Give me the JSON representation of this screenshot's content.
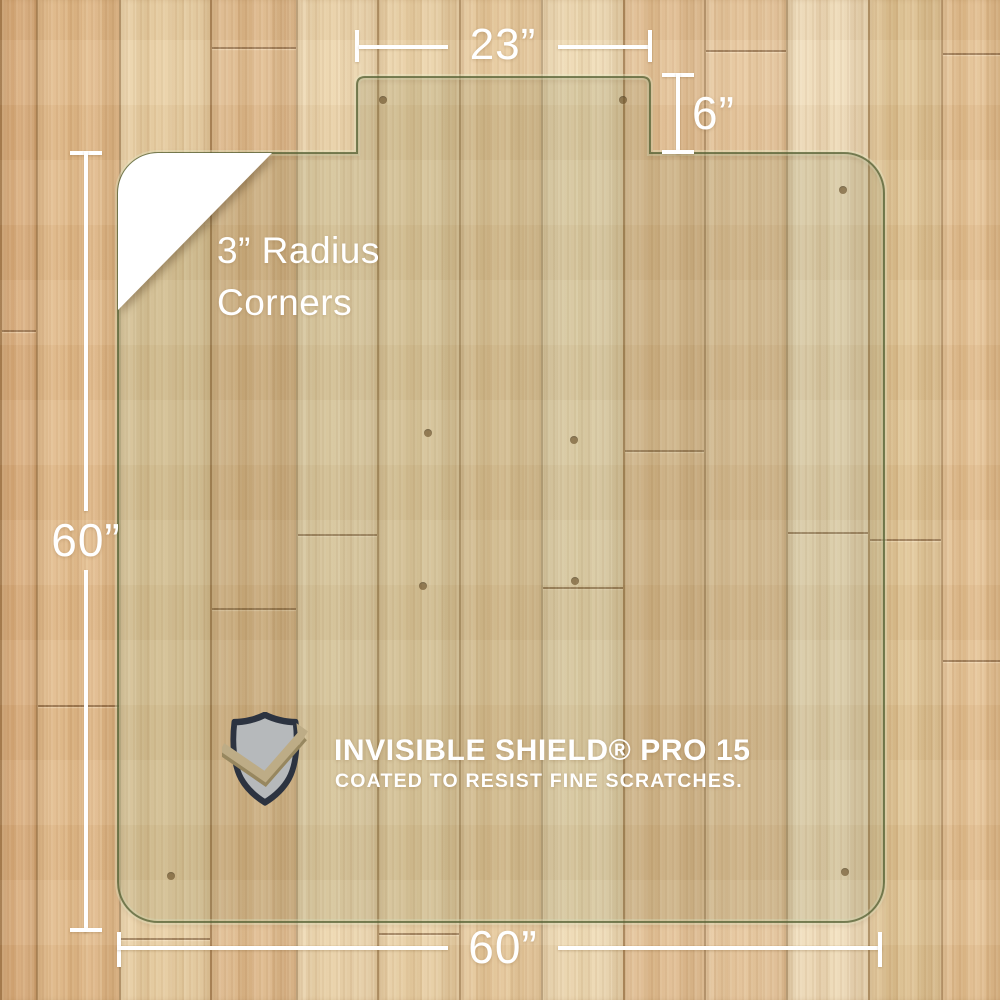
{
  "dimensions": {
    "top_width_label": "23”",
    "notch_depth_label": "6”",
    "side_height_label": "60”",
    "bottom_width_label": "60”"
  },
  "corner_note": {
    "line1": "3” Radius",
    "line2": "Corners"
  },
  "badge": {
    "title": "INVISIBLE SHIELD® PRO 15",
    "subtitle": "COATED TO RESIST FINE SCRATCHES."
  },
  "colors": {
    "dimension_lines": "#ffffff",
    "mat_tint": "rgba(106,112,62,0.16)",
    "mat_edge": "rgba(78,90,45,0.72)",
    "mat_edge_halo": "rgba(235,240,205,0.38)",
    "floor_base": "#e7c99c",
    "plank_seam": "rgba(122,86,44,0.45)",
    "wood_joint": "rgba(108,74,40,0.6)",
    "knot_dot": "#6f4f2a",
    "shield_fill": "#b6b9bb",
    "shield_outline": "#2c3340",
    "check_color": "#bdac86",
    "check_shadow": "#97875f"
  },
  "floor": {
    "planks": [
      {
        "x": 0,
        "w": 36,
        "color": "#d8aa78"
      },
      {
        "x": 36,
        "w": 83,
        "color": "#e2b987"
      },
      {
        "x": 119,
        "w": 91,
        "color": "#ead0a3"
      },
      {
        "x": 210,
        "w": 86,
        "color": "#dfb98a"
      },
      {
        "x": 296,
        "w": 81,
        "color": "#eed7ae"
      },
      {
        "x": 377,
        "w": 82,
        "color": "#ebd2a6"
      },
      {
        "x": 459,
        "w": 82,
        "color": "#e8ca9c"
      },
      {
        "x": 541,
        "w": 82,
        "color": "#f0dcb5"
      },
      {
        "x": 623,
        "w": 81,
        "color": "#e3bf92"
      },
      {
        "x": 704,
        "w": 82,
        "color": "#e8c79c"
      },
      {
        "x": 786,
        "w": 82,
        "color": "#f1debb"
      },
      {
        "x": 868,
        "w": 73,
        "color": "#dfc392"
      },
      {
        "x": 941,
        "w": 59,
        "color": "#e4bf8f"
      }
    ],
    "joints": [
      {
        "x": 210,
        "w": 86,
        "y": 47
      },
      {
        "x": 704,
        "w": 82,
        "y": 50
      },
      {
        "x": 941,
        "w": 59,
        "y": 53
      },
      {
        "x": 0,
        "w": 36,
        "y": 330
      },
      {
        "x": 36,
        "w": 83,
        "y": 705
      },
      {
        "x": 296,
        "w": 81,
        "y": 534
      },
      {
        "x": 623,
        "w": 81,
        "y": 450
      },
      {
        "x": 541,
        "w": 82,
        "y": 587
      },
      {
        "x": 786,
        "w": 82,
        "y": 532
      },
      {
        "x": 868,
        "w": 73,
        "y": 539
      },
      {
        "x": 210,
        "w": 86,
        "y": 608
      },
      {
        "x": 941,
        "w": 59,
        "y": 660
      },
      {
        "x": 119,
        "w": 91,
        "y": 938
      },
      {
        "x": 377,
        "w": 82,
        "y": 933
      }
    ]
  },
  "mat": {
    "dots": [
      {
        "x": 383,
        "y": 100
      },
      {
        "x": 623,
        "y": 100
      },
      {
        "x": 843,
        "y": 190
      },
      {
        "x": 428,
        "y": 433
      },
      {
        "x": 574,
        "y": 440
      },
      {
        "x": 423,
        "y": 586
      },
      {
        "x": 575,
        "y": 581
      },
      {
        "x": 171,
        "y": 876
      },
      {
        "x": 845,
        "y": 872
      }
    ]
  }
}
